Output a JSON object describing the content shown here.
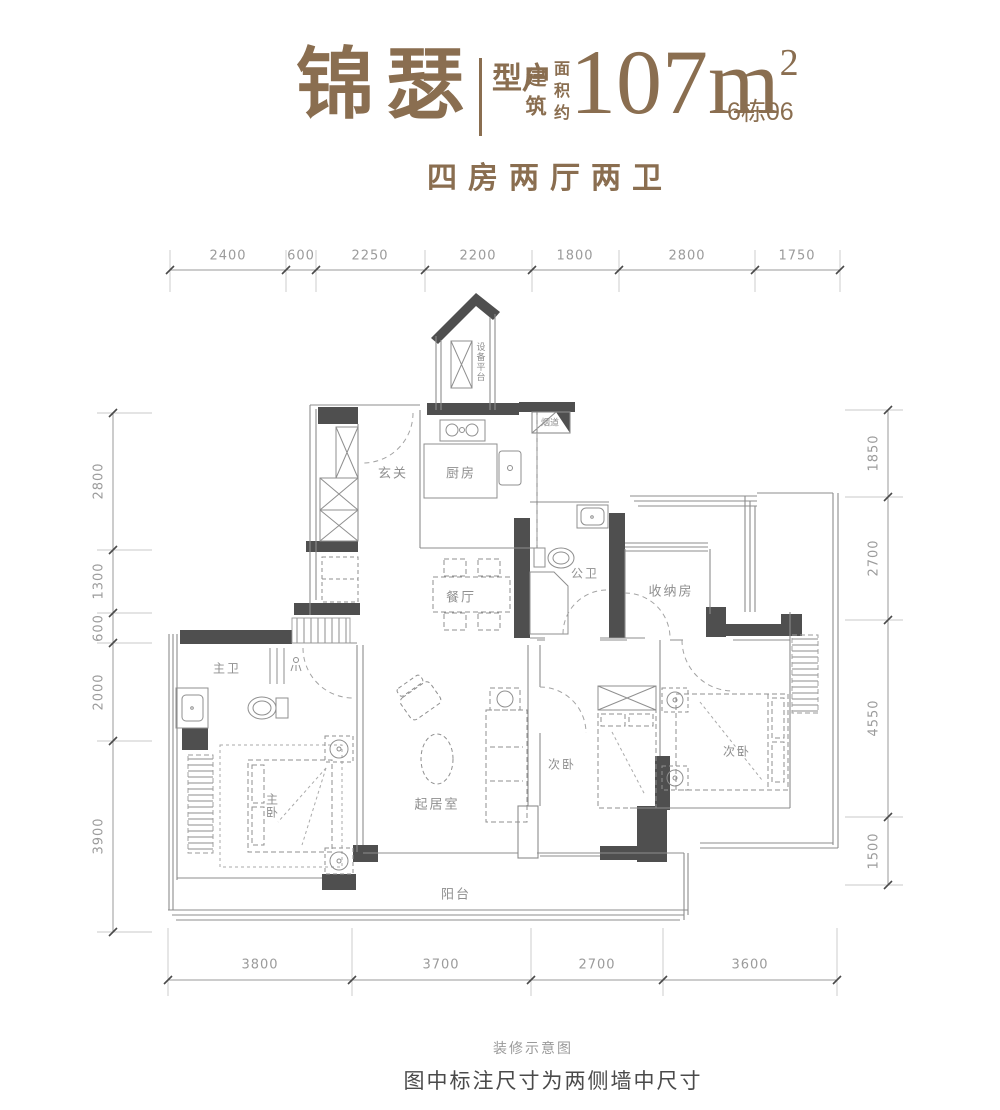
{
  "header": {
    "brand": "锦瑟",
    "type_label": "户型",
    "area_label_col1": "建筑",
    "area_label_col2": "面积约",
    "area_value": "107m",
    "area_superscript": "2",
    "building_unit": "6栋06",
    "subtitle": "四房两厅两卫"
  },
  "rooms": {
    "entry": "玄关",
    "kitchen": "厨房",
    "equipment_platform": "设备平台",
    "flue": "烟道",
    "dining": "餐厅",
    "public_bath": "公卫",
    "storage": "收纳房",
    "master_bath": "主卫",
    "master_bedroom": "主卧",
    "living": "起居室",
    "bedroom_mid": "次卧",
    "bedroom_right": "次卧",
    "balcony": "阳台"
  },
  "dimensions": {
    "top": [
      "2400",
      "600",
      "2250",
      "2200",
      "1800",
      "2800",
      "1750"
    ],
    "bottom": [
      "3800",
      "3700",
      "2700",
      "3600"
    ],
    "left": [
      "2800",
      "1300",
      "600",
      "2000",
      "3900"
    ],
    "right": [
      "1850",
      "2700",
      "4550",
      "1500"
    ]
  },
  "captions": {
    "note_small": "装修示意图",
    "note_large": "图中标注尺寸为两侧墙中尺寸"
  },
  "colors": {
    "brand": "#8a6e50",
    "wall_dark": "#4f4f4f",
    "line": "#8c8c8c",
    "dim_text": "#9b9b9b"
  }
}
